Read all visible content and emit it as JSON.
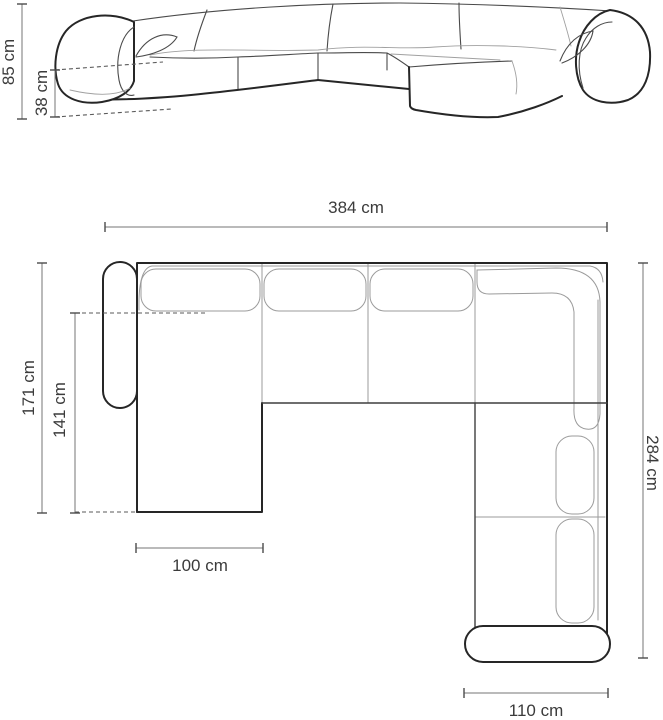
{
  "diagram": {
    "type": "furniture-dimension-diagram",
    "subject": "corner sofa with left chaise and right chaise",
    "unit": "cm",
    "colors": {
      "background": "#ffffff",
      "outline": "#262626",
      "inner_line": "#9b9b9b",
      "dimension_line": "#767676",
      "text": "#3b3b3b"
    },
    "front_view": {
      "name": "front-elevation-view",
      "dimensions": {
        "total_height": {
          "label": "85 cm",
          "value": 85
        },
        "seat_height": {
          "label": "38 cm",
          "value": 38
        }
      }
    },
    "top_view": {
      "name": "top-plan-view",
      "dimensions": {
        "total_width": {
          "label": "384 cm",
          "value": 384
        },
        "left_side_depth": {
          "label": "171 cm",
          "value": 171
        },
        "left_inner_depth": {
          "label": "141 cm",
          "value": 141
        },
        "right_side_depth": {
          "label": "284 cm",
          "value": 284
        },
        "left_chaise_width": {
          "label": "100 cm",
          "value": 100
        },
        "right_chaise_width": {
          "label": "110 cm",
          "value": 110
        }
      }
    }
  }
}
